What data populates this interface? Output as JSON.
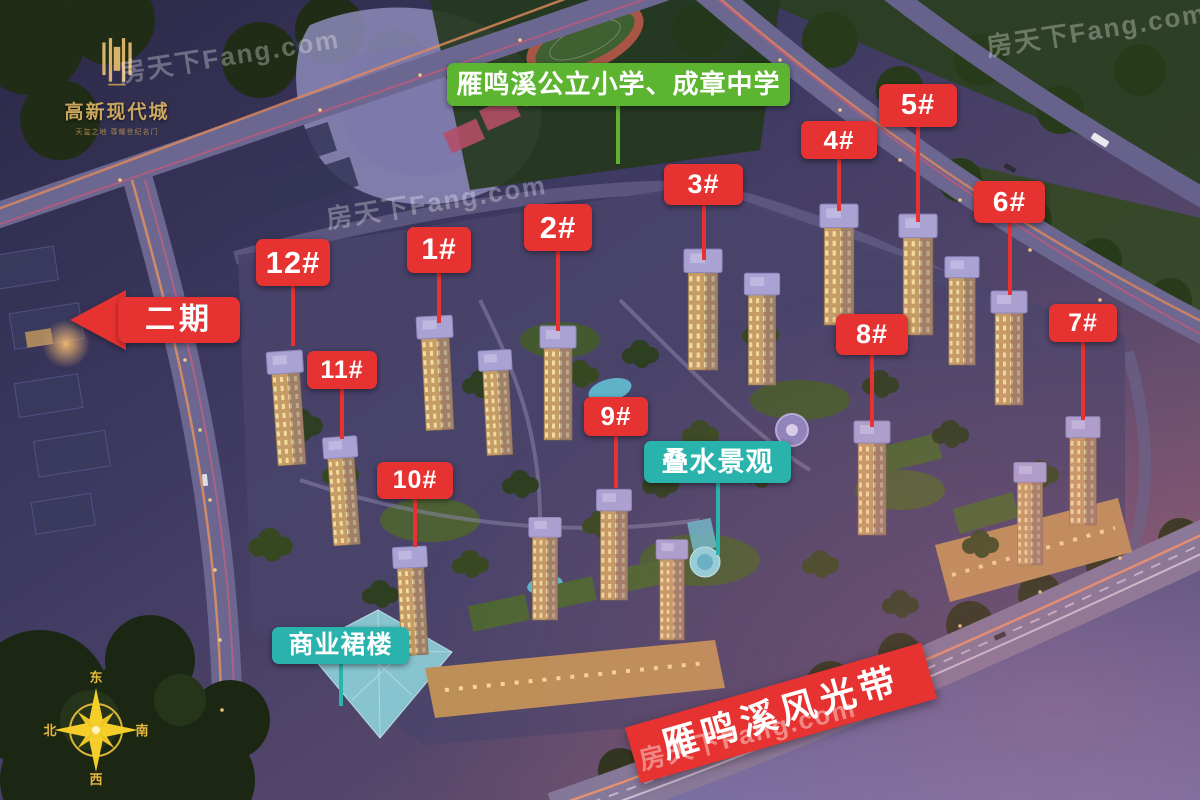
{
  "logo": {
    "name": "高新现代城",
    "tagline": "天玺之地 尊耀世纪名门",
    "emblem": "gold-gate-emblem"
  },
  "school_label": {
    "text": "雁鸣溪公立小学、成章中学",
    "color": "#5cb431"
  },
  "phase_arrow": {
    "label": "二期",
    "direction": "left",
    "color": "#e63230"
  },
  "building_labels": [
    {
      "label": "12#",
      "x": 256,
      "y": 239,
      "w": 74,
      "h": 47,
      "line": 60,
      "font": 31
    },
    {
      "label": "11#",
      "x": 307,
      "y": 351,
      "w": 70,
      "h": 38,
      "line": 50,
      "font": 25
    },
    {
      "label": "1#",
      "x": 407,
      "y": 227,
      "w": 64,
      "h": 46,
      "line": 50,
      "font": 30
    },
    {
      "label": "10#",
      "x": 377,
      "y": 462,
      "w": 76,
      "h": 37,
      "line": 48,
      "font": 25
    },
    {
      "label": "2#",
      "x": 524,
      "y": 204,
      "w": 68,
      "h": 47,
      "line": 80,
      "font": 31
    },
    {
      "label": "9#",
      "x": 584,
      "y": 397,
      "w": 64,
      "h": 39,
      "line": 52,
      "font": 26
    },
    {
      "label": "3#",
      "x": 664,
      "y": 164,
      "w": 79,
      "h": 41,
      "line": 55,
      "font": 27
    },
    {
      "label": "4#",
      "x": 801,
      "y": 121,
      "w": 76,
      "h": 38,
      "line": 52,
      "font": 26
    },
    {
      "label": "5#",
      "x": 879,
      "y": 84,
      "w": 78,
      "h": 43,
      "line": 95,
      "font": 29
    },
    {
      "label": "6#",
      "x": 974,
      "y": 181,
      "w": 71,
      "h": 42,
      "line": 72,
      "font": 28
    },
    {
      "label": "8#",
      "x": 836,
      "y": 314,
      "w": 72,
      "h": 41,
      "line": 72,
      "font": 27
    },
    {
      "label": "7#",
      "x": 1049,
      "y": 304,
      "w": 68,
      "h": 38,
      "line": 78,
      "font": 25
    }
  ],
  "feature_labels": [
    {
      "label": "叠水景观",
      "x": 644,
      "y": 441,
      "w": 147,
      "h": 42,
      "line": 72,
      "font": 27
    },
    {
      "label": "商业裙楼",
      "x": 272,
      "y": 627,
      "w": 137,
      "h": 37,
      "line": 42,
      "font": 25
    }
  ],
  "banner": {
    "text": "雁鸣溪风光带",
    "color": "#e63230"
  },
  "compass": {
    "east": "东",
    "south": "南",
    "west": "西",
    "north": "北"
  },
  "watermark": {
    "text": "房天下Fang.com"
  },
  "colors": {
    "label_red": "#e63230",
    "label_green": "#5cb431",
    "label_teal": "#2ab3ad",
    "logo_gold": "#cba65f",
    "compass_gold": "#f6ce2a"
  }
}
